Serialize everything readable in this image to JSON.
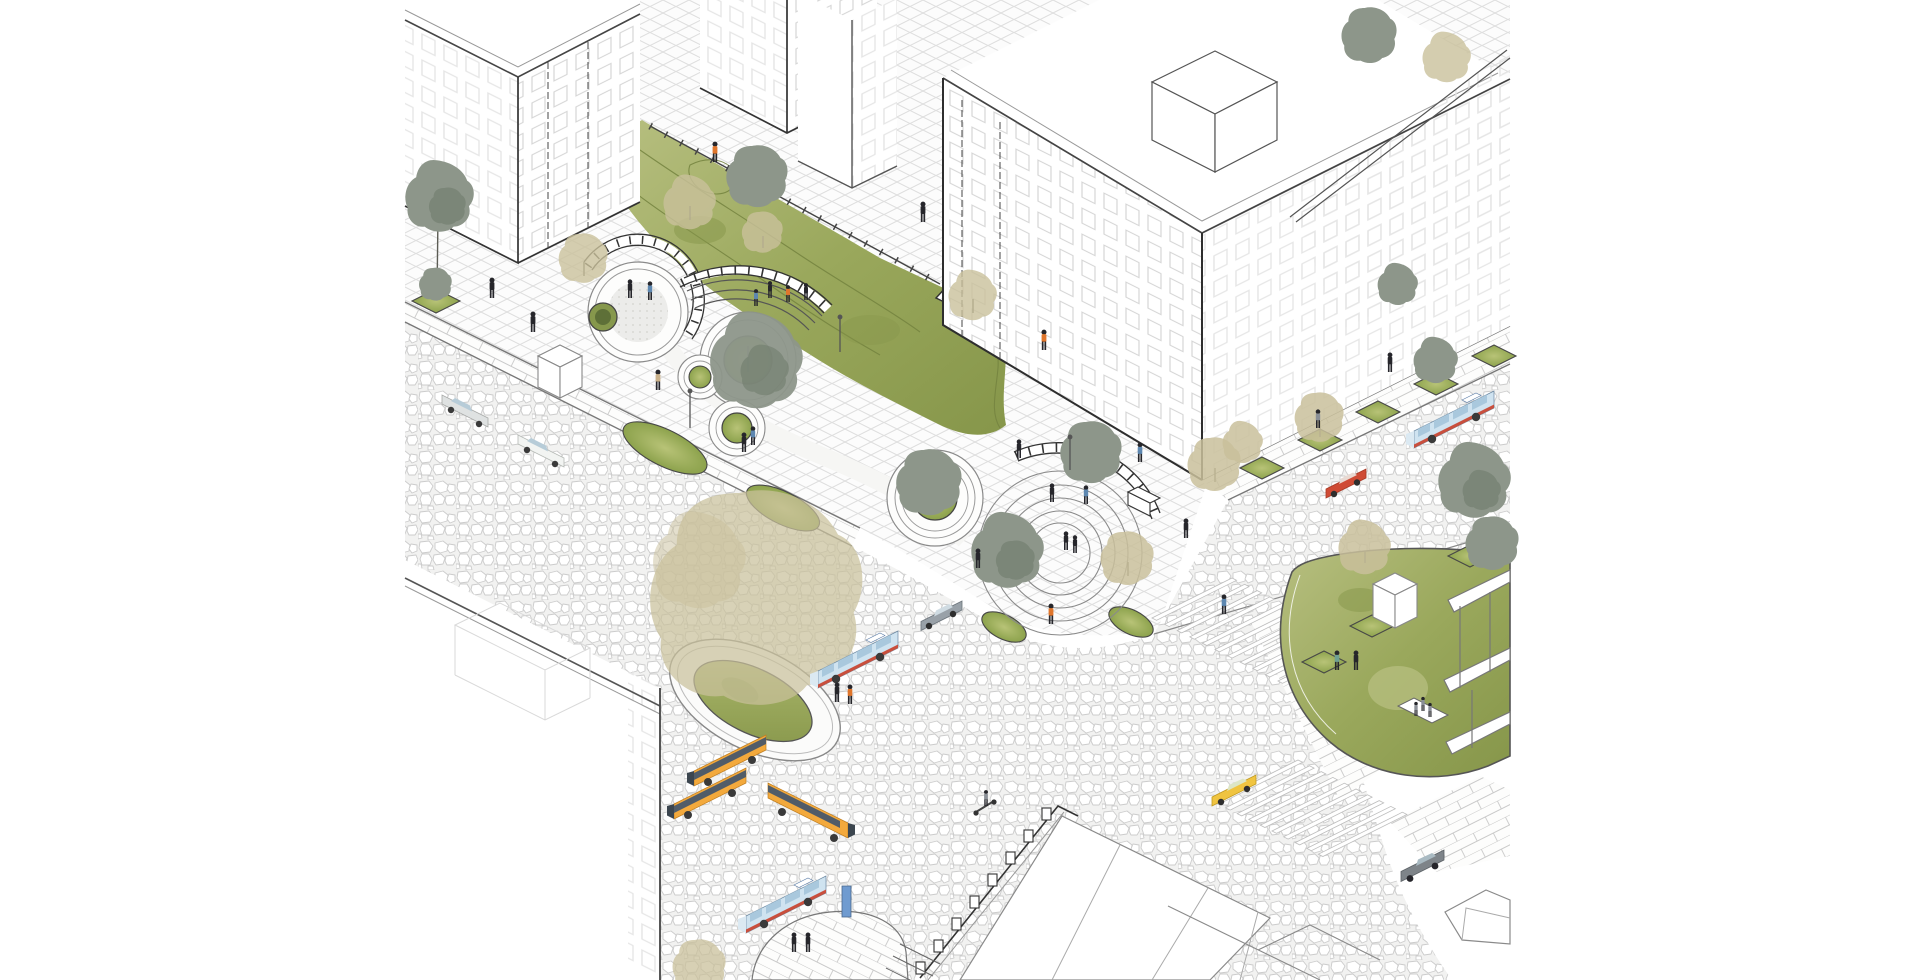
{
  "meta": {
    "kind": "axonometric-architectural-illustration",
    "subject": "Urban intersection redesign: pocket park with circular terraced planters, curved benches with railings, shared cobblestone street, bus stop island, crosswalks, surrounding apartment blocks",
    "visible_text": ""
  },
  "palette": {
    "paper": "#ffffff",
    "inkDark": "#2e2e2e",
    "inkMid": "#8f8f8f",
    "inkLight": "#d9d9d9",
    "cobLine": "#cccccc",
    "gridLine": "#dedede",
    "brickLine": "#c9c9c9",
    "ghostLine": "#e6e6e6",
    "lawnA": "#b7bf80",
    "lawnB": "#9aa85c",
    "lawnC": "#86964a",
    "contour": "#74833f",
    "moundA": "#b8c377",
    "moundB": "#8ca24c",
    "rimDark": "#474747",
    "poolGreen": "#86984c",
    "khaki": "#c9c09b",
    "khakiLight": "#dcd5b6",
    "sage": "#8d968a",
    "sageDark": "#6e7a6a",
    "trunk": "#5c5c54",
    "busBlueBody": "#cfe3f0",
    "busBlueRoof": "#7aa0d4",
    "busBlueWin": "#a9c8dd",
    "busRedStripe": "#c94f3d",
    "busYellow": "#f3a93c",
    "busYellowLight": "#f6bd62",
    "busWinBand": "#515c68",
    "taxiYellow": "#f0c440",
    "carRed": "#cf4b35",
    "carRedDark": "#a83a26",
    "carGray": "#99a1a8",
    "carLight": "#dfe2e2",
    "carWhite": "#f2f4f2",
    "carWin": "#b7ccd8",
    "suvGray": "#7e8489",
    "stopBlue": "#6f9bd0",
    "pDark": "#26262b",
    "pOrange": "#e0762c",
    "pBlue": "#5d87b0",
    "pTeal": "#6fa092",
    "pGray": "#8a8f96",
    "pKhaki": "#c9b089"
  },
  "inventory": {
    "buses": [
      {
        "color": "blue-red-stripe",
        "location": "upper-right street"
      },
      {
        "color": "blue-red-stripe",
        "location": "beside oval bus island"
      },
      {
        "color": "blue-red-stripe",
        "location": "bottom plaza at stop island"
      },
      {
        "color": "yellow",
        "location": "bottom-left plaza"
      },
      {
        "color": "yellow",
        "location": "bottom-left plaza"
      },
      {
        "color": "yellow",
        "location": "bottom plaza heading right"
      }
    ],
    "cars": [
      {
        "color": "white",
        "location": "left road"
      },
      {
        "color": "light-gray",
        "location": "left road"
      },
      {
        "color": "gray",
        "location": "center near park edge"
      },
      {
        "color": "red",
        "location": "right street"
      },
      {
        "color": "yellow-taxi",
        "location": "bottom-right road"
      },
      {
        "color": "dark-gray-suv",
        "location": "bottom-right road"
      }
    ],
    "park_features": [
      "round terrace with railing and pool planter",
      "amphitheater arc benches",
      "ring planters with trees",
      "flat concentric-ring plaza with arc bench",
      "hatched accessibility ramp",
      "lawn with contour paths",
      "oval bus island with large tree",
      "teardrop lawn with sculpture and pergola"
    ],
    "crosswalks": 2,
    "tree_kinds": [
      "khaki-canopy",
      "sage-canopy"
    ],
    "pedestrian_count": 35
  }
}
